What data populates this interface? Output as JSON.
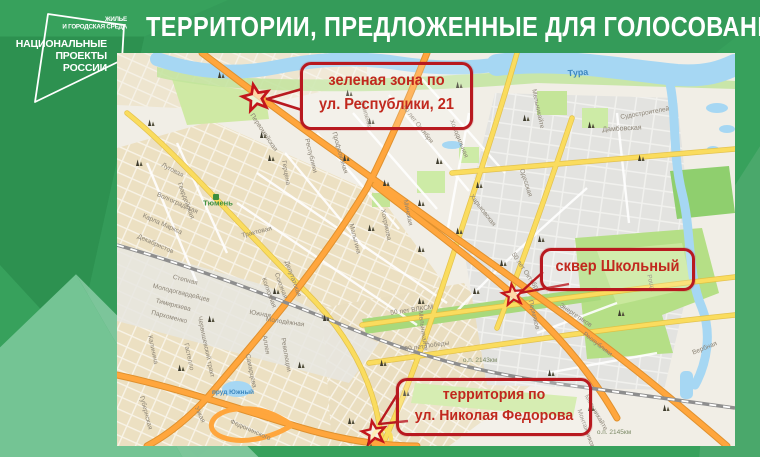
{
  "header": {
    "title": "ТЕРРИТОРИИ, ПРЕДЛОЖЕННЫЕ ДЛЯ ГОЛОСОВАНИЯ"
  },
  "logo": {
    "program_line1": "ЖИЛЬЕ",
    "program_line2": "И ГОРОДСКАЯ СРЕДА",
    "brand_line1": "НАЦИОНАЛЬНЫЕ",
    "brand_line2": "ПРОЕКТЫ",
    "brand_line3": "РОССИИ"
  },
  "colors": {
    "background_green": "#37a15c",
    "facet_dark_green": "#2d9150",
    "facet_light_green": "#74c494",
    "callout_red": "#b8191f",
    "map_background": "#f1eee6",
    "road_orange": "#ffa63d",
    "road_yellow": "#fadc5e",
    "river_blue": "#a6d7f3",
    "park_green": "#c7e89c"
  },
  "map": {
    "callouts": [
      {
        "id": "green-zone-respubliki",
        "lines": [
          "зеленая зона по",
          "ул. Республики, 21"
        ]
      },
      {
        "id": "skver-shkolny",
        "lines": [
          "сквер Школьный"
        ]
      },
      {
        "id": "territory-fedorova",
        "lines": [
          "территория по",
          "ул. Николая Федорова"
        ]
      }
    ],
    "street_labels": [
      {
        "t": "Тура",
        "x": 461,
        "y": 20,
        "r": -4,
        "c": "blue",
        "s": 9
      },
      {
        "t": "Судостроителей",
        "x": 528,
        "y": 61,
        "r": -10
      },
      {
        "t": "Дамбовская",
        "x": 505,
        "y": 76,
        "r": -3,
        "s": 7
      },
      {
        "t": "Осипенко",
        "x": 248,
        "y": 62,
        "r": 74
      },
      {
        "t": "Республики",
        "x": 193,
        "y": 103,
        "r": 76
      },
      {
        "t": "Республики",
        "x": 480,
        "y": 292,
        "r": 38
      },
      {
        "t": "Первомайская",
        "x": 146,
        "y": 80,
        "r": 56
      },
      {
        "t": "Профсоюзная",
        "x": 222,
        "y": 100,
        "r": 74
      },
      {
        "t": "50 лет Октября",
        "x": 300,
        "y": 72,
        "r": 52
      },
      {
        "t": "50 лет Октября",
        "x": 408,
        "y": 220,
        "r": 56
      },
      {
        "t": "Мельникайте",
        "x": 420,
        "y": 56,
        "r": 78
      },
      {
        "t": "Мельникайте",
        "x": 305,
        "y": 278,
        "r": 82
      },
      {
        "t": "Мельникайте",
        "x": 478,
        "y": 360,
        "r": 60
      },
      {
        "t": "Одесская",
        "x": 408,
        "y": 130,
        "r": 72
      },
      {
        "t": "Харьковская",
        "x": 365,
        "y": 158,
        "r": 52
      },
      {
        "t": "Холодильная",
        "x": 341,
        "y": 86,
        "r": 68
      },
      {
        "t": "Минская",
        "x": 290,
        "y": 160,
        "r": 78
      },
      {
        "t": "Хохрякова",
        "x": 268,
        "y": 172,
        "r": 78
      },
      {
        "t": "Малыгина",
        "x": 237,
        "y": 186,
        "r": 76
      },
      {
        "t": "Герцена",
        "x": 168,
        "y": 120,
        "r": 80
      },
      {
        "t": "Луговая",
        "x": 55,
        "y": 118,
        "r": 28
      },
      {
        "t": "Гвардейская",
        "x": 68,
        "y": 148,
        "r": 70
      },
      {
        "t": "Волгоградская",
        "x": 60,
        "y": 151,
        "r": 24
      },
      {
        "t": "Карла Маркса",
        "x": 45,
        "y": 172,
        "r": 24
      },
      {
        "t": "Декабристов",
        "x": 38,
        "y": 192,
        "r": 24
      },
      {
        "t": "Трактовая",
        "x": 140,
        "y": 180,
        "r": -14
      },
      {
        "t": "Тюмень",
        "x": 101,
        "y": 150,
        "r": 0,
        "c": "green",
        "s": 7.5
      },
      {
        "t": "Червишевский тракт",
        "x": 88,
        "y": 294,
        "r": 78
      },
      {
        "t": "Степная",
        "x": 68,
        "y": 228,
        "r": 14
      },
      {
        "t": "Молодогвардейцев",
        "x": 64,
        "y": 241,
        "r": 14
      },
      {
        "t": "Тимирязева",
        "x": 56,
        "y": 253,
        "r": 14
      },
      {
        "t": "Пархоменко",
        "x": 52,
        "y": 265,
        "r": 14
      },
      {
        "t": "Калинина",
        "x": 35,
        "y": 297,
        "r": 78
      },
      {
        "t": "Гастелло",
        "x": 71,
        "y": 304,
        "r": 78
      },
      {
        "t": "Южная",
        "x": 143,
        "y": 262,
        "r": 10
      },
      {
        "t": "Молодёжная",
        "x": 168,
        "y": 270,
        "r": 8
      },
      {
        "t": "Самарцева",
        "x": 133,
        "y": 318,
        "r": 78
      },
      {
        "t": "Революции",
        "x": 168,
        "y": 302,
        "r": 80
      },
      {
        "t": "Аллея",
        "x": 148,
        "y": 292,
        "r": 80
      },
      {
        "t": "Депутатская",
        "x": 175,
        "y": 226,
        "r": 70
      },
      {
        "t": "Союзная",
        "x": 163,
        "y": 233,
        "r": 70
      },
      {
        "t": "Колхозная",
        "x": 151,
        "y": 240,
        "r": 70
      },
      {
        "t": "Губернская",
        "x": 28,
        "y": 360,
        "r": 75
      },
      {
        "t": "Узкая",
        "x": 82,
        "y": 362,
        "r": 65
      },
      {
        "t": "Федюнинского",
        "x": 133,
        "y": 378,
        "r": 24
      },
      {
        "t": "50 лет ВЛКСМ",
        "x": 295,
        "y": 258,
        "r": -8
      },
      {
        "t": "30 лет Победы",
        "x": 310,
        "y": 294,
        "r": -8
      },
      {
        "t": "Пермяков",
        "x": 416,
        "y": 262,
        "r": 76
      },
      {
        "t": "Энергетиков",
        "x": 458,
        "y": 263,
        "r": 34
      },
      {
        "t": "Роща",
        "x": 533,
        "y": 230,
        "r": 75
      },
      {
        "t": "Вербная",
        "x": 588,
        "y": 296,
        "r": -22
      },
      {
        "t": "Монтажников",
        "x": 468,
        "y": 376,
        "r": 70
      },
      {
        "t": "пруд Южный",
        "x": 116,
        "y": 340,
        "r": 0,
        "c": "blue"
      },
      {
        "t": "о.п. 2143км",
        "x": 363,
        "y": 308,
        "r": 0,
        "c": "rail"
      },
      {
        "t": "о.п. 2145км",
        "x": 497,
        "y": 380,
        "r": 0,
        "c": "rail"
      }
    ],
    "landmarks": [
      [
        30,
        60
      ],
      [
        18,
        100
      ],
      [
        100,
        12
      ],
      [
        142,
        72
      ],
      [
        150,
        95
      ],
      [
        228,
        30
      ],
      [
        250,
        58
      ],
      [
        225,
        95
      ],
      [
        265,
        120
      ],
      [
        318,
        98
      ],
      [
        300,
        140
      ],
      [
        338,
        22
      ],
      [
        358,
        122
      ],
      [
        250,
        165
      ],
      [
        300,
        186
      ],
      [
        338,
        168
      ],
      [
        382,
        200
      ],
      [
        420,
        176
      ],
      [
        355,
        228
      ],
      [
        300,
        238
      ],
      [
        262,
        300
      ],
      [
        285,
        330
      ],
      [
        180,
        302
      ],
      [
        90,
        256
      ],
      [
        60,
        305
      ],
      [
        430,
        310
      ],
      [
        470,
        345
      ],
      [
        500,
        250
      ],
      [
        545,
        345
      ],
      [
        248,
        382
      ],
      [
        405,
        55
      ],
      [
        470,
        62
      ],
      [
        520,
        95
      ],
      [
        230,
        358
      ],
      [
        155,
        228
      ],
      [
        205,
        255
      ],
      [
        472,
        390
      ]
    ]
  }
}
